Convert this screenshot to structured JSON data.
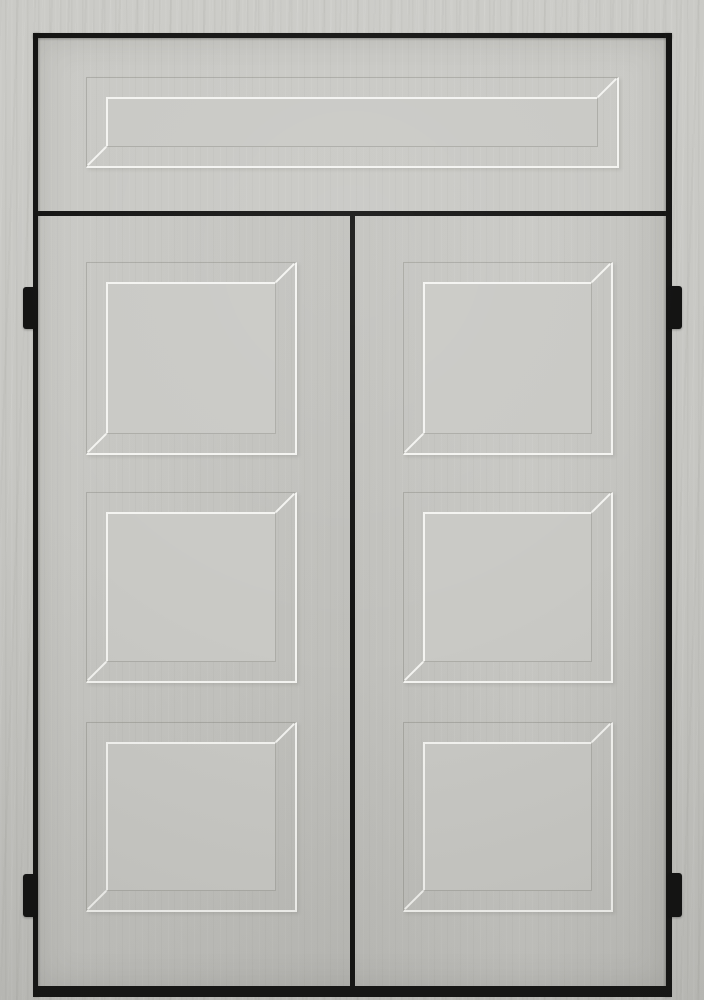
{
  "scene": {
    "description": "Front view product rendering of a light-gray painted wood double door with a fixed transom panel above, thin black frame reveal lines, and black hinges. No text, handles or hardware other than hinges is visible.",
    "object": "double-door-with-transom",
    "finish": "light gray paint with subtle vertical woodgrain texture",
    "transom": {
      "panels": 1,
      "panel_style": "wide recessed rectangular panel"
    },
    "left_door": {
      "panels": 3,
      "panel_style": "recessed square shaker panels"
    },
    "right_door": {
      "panels": 3,
      "panel_style": "recessed square shaker panels"
    },
    "hinges": {
      "left_count": 2,
      "right_count": 2,
      "style": "small black barrel hinges"
    },
    "hardware": "none visible"
  },
  "colors": {
    "wall": "#c6c6c2",
    "door_face": "#c7c7c3",
    "panel_center": "#c9c9c5",
    "frame_black": "#141413",
    "hinge_black": "#121211",
    "bevel_highlight": "#f4f4f1",
    "bevel_shadow": "rgba(108,108,100,0.3)"
  }
}
